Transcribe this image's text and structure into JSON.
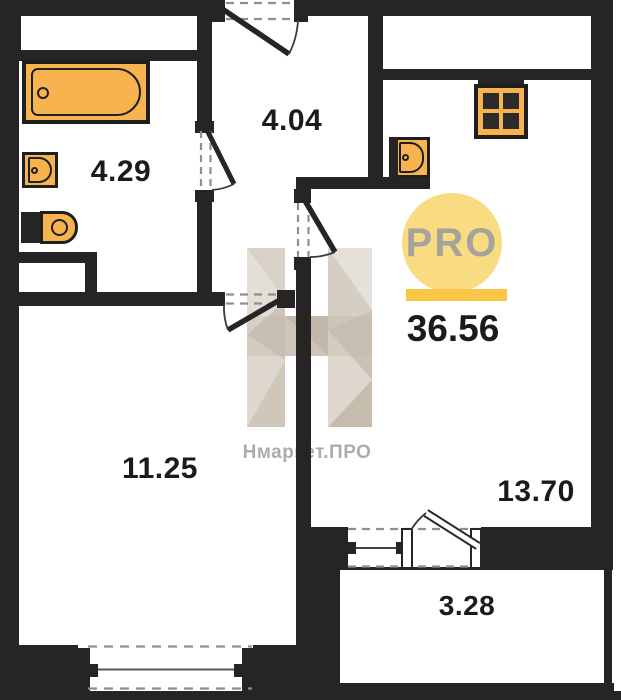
{
  "plan": {
    "total_area": "36.56",
    "rooms": [
      {
        "id": "bathroom",
        "area": "4.29"
      },
      {
        "id": "hallway",
        "area": "4.04"
      },
      {
        "id": "living-room",
        "area": "11.25"
      },
      {
        "id": "kitchen-living",
        "area": "13.70"
      },
      {
        "id": "balcony",
        "area": "3.28"
      }
    ],
    "fixtures": [
      "bathtub",
      "washbasin",
      "toilet",
      "kitchen-sink",
      "stove"
    ],
    "openings": [
      "entrance-door",
      "bathroom-door",
      "living-room-door",
      "kitchen-living-door",
      "balcony-door",
      "balcony-window",
      "living-room-window"
    ]
  },
  "branding": {
    "logo_circle_text": "PRO",
    "watermark_text": "Нмаркет.ПРО"
  },
  "colors": {
    "wall": "#262424",
    "fixture": "#F7B44E",
    "fixture-outline": "#1f1f1f",
    "logo-circle": "#F9DB81",
    "logo-bar": "#FBC547",
    "logo-text": "#A7A29B",
    "label-text": "#1b1b1b",
    "dash": "#8f8f8f",
    "watermark-text": "#ACACAC",
    "wm1": "#D8D2C8",
    "wm2": "#E3DED6",
    "wm3": "#CDC5B9",
    "wm4": "#DDD7CE",
    "wm5": "#CFC7BA",
    "wm6": "#E5E1DA",
    "wm7": "#D5CEC3",
    "wm8": "#CBC2B5",
    "wm9": "#C6BCAE",
    "wm10": "#C3B9AB",
    "wm11": "#CEC5B8"
  }
}
